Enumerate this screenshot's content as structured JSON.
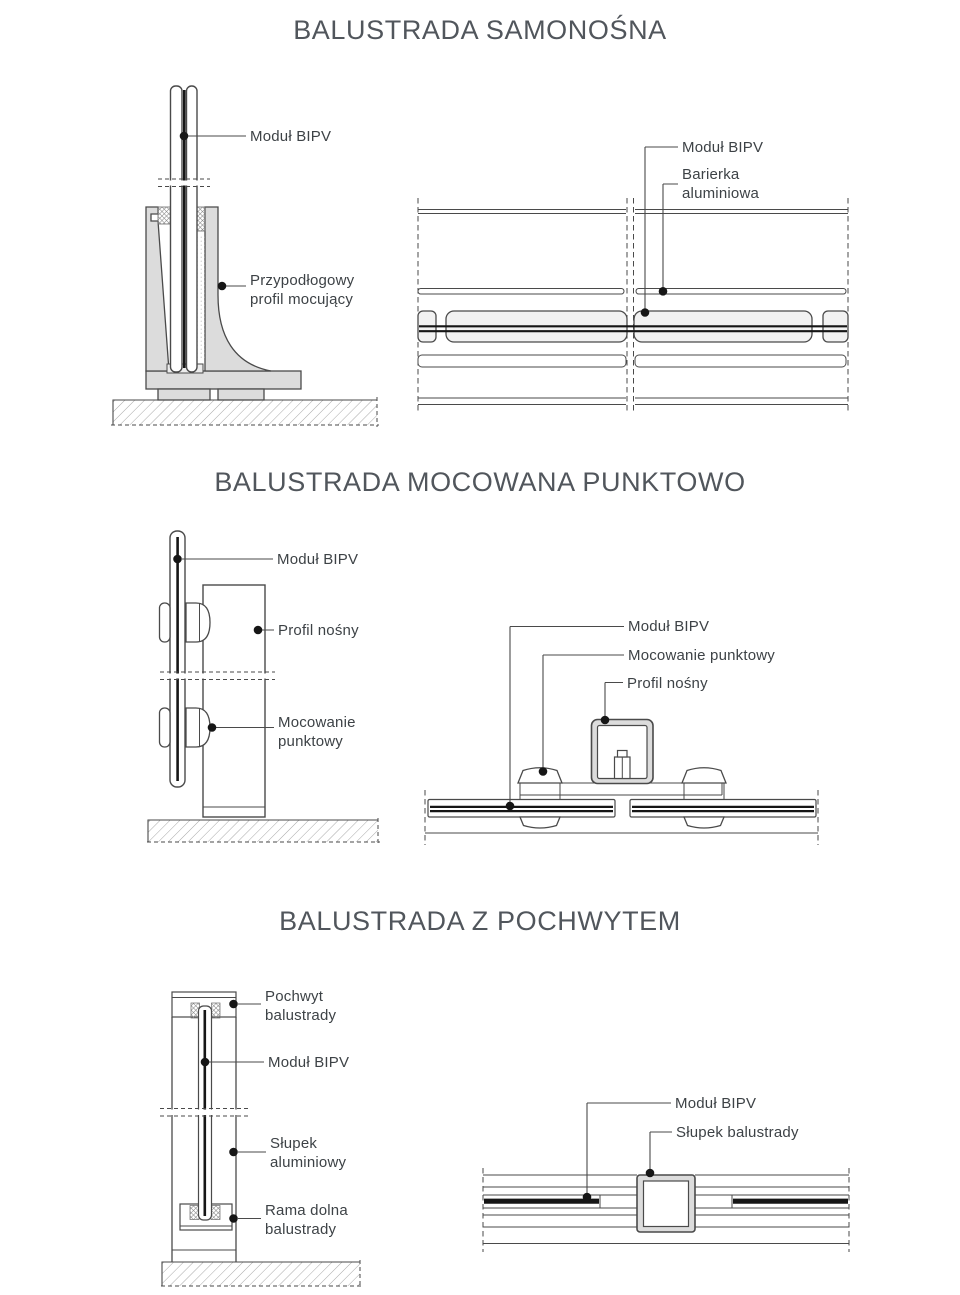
{
  "page": {
    "width": 960,
    "height": 1295,
    "background": "#ffffff"
  },
  "colors": {
    "ink": "#4a4a4a",
    "fill-light": "#dcdcdc",
    "fill-band": "#f2f2f2",
    "core": "#161616",
    "label-text": "#3d4246",
    "title-text": "#51565c"
  },
  "sections": {
    "samonosna": {
      "title": "BALUSTRADA SAMONOŚNA",
      "left_labels": {
        "modul": "Moduł BIPV",
        "profil_line1": "Przypodłogowy",
        "profil_line2": "profil mocujący"
      },
      "right_labels": {
        "modul": "Moduł BIPV",
        "barierka_line1": "Barierka",
        "barierka_line2": "aluminiowa"
      }
    },
    "punktowo": {
      "title": "BALUSTRADA MOCOWANA PUNKTOWO",
      "left_labels": {
        "modul": "Moduł BIPV",
        "profil": "Profil nośny",
        "mocowanie_line1": "Mocowanie",
        "mocowanie_line2": "punktowy"
      },
      "right_labels": {
        "modul": "Moduł BIPV",
        "mocowanie": "Mocowanie punktowy",
        "profil": "Profil nośny"
      }
    },
    "pochwytem": {
      "title": "BALUSTRADA Z POCHWYTEM",
      "left_labels": {
        "pochwyt_line1": "Pochwyt",
        "pochwyt_line2": "balustrady",
        "modul": "Moduł BIPV",
        "slupek_line1": "Słupek",
        "slupek_line2": "aluminiowy",
        "rama_line1": "Rama dolna",
        "rama_line2": "balustrady"
      },
      "right_labels": {
        "modul": "Moduł BIPV",
        "slupek": "Słupek balustrady"
      }
    }
  }
}
